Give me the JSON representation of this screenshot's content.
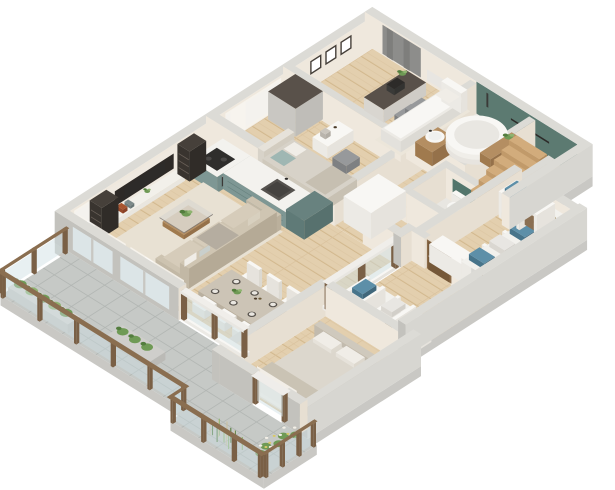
{
  "scene": {
    "description": "3D isometric cutaway floor plan rendering of a furnished apartment with wrap-around terrace",
    "width_px": 615,
    "height_px": 490,
    "background": "#ffffff"
  },
  "palette": {
    "wallTop": "#dcdbd6",
    "wallInner": "#efe8dd",
    "wallInnerDark": "#e7dfd2",
    "wallOuterSW": "#c3c2bd",
    "wallOuterSE": "#d7d6d1",
    "slab": "#c9c8c4",
    "woodFloor": "#e3cfae",
    "woodFloorLine": "#d2b88e",
    "woodFloorLine2": "#d9c19c",
    "terraceTile": "#c6c9c6",
    "terraceTileLine": "#b2b6b3",
    "bathFloor": "#eae8e3",
    "wcFloor": "#e8e6e1",
    "greenWall": "#5c7a71",
    "greenPanel": "#52756b",
    "kitchenTeal": "#7e9794",
    "kitchenTealFront": "#738c89",
    "kitchenTealDark": "#68827f",
    "counter": "#f3f2ee",
    "white": "#f8f7f4",
    "white2": "#eceae5",
    "white3": "#e6e3dd",
    "beige": "#cdc3b0",
    "beigeDark": "#b9ae9a",
    "rug": "#e8e1d3",
    "rug2": "#ece6da",
    "darkWood": "#46403a",
    "darkWood2": "#59514a",
    "gray": "#97999b",
    "grayDark": "#7e8082",
    "glass": "rgba(205,222,226,0.45)",
    "windowGlass": "#dde7e9",
    "railWood": "#8a6e50",
    "railWoodDark": "#7a6046",
    "plant": "#6f9a55",
    "plantDark": "#537d3e",
    "plantLight": "#8fb470",
    "grassTan": "#cbbf9b",
    "sheer": "rgba(247,244,238,0.88)",
    "curtainGray": "#8d8d8b",
    "curtainGrayDark": "#7e7e7c",
    "black": "#2d2b29",
    "blueBox": "#5d8fa8",
    "blueBoxDark": "#47748a",
    "bedding": "#d7d2c8",
    "beddingDark": "#c6bfb1",
    "pillow": "#f0ede7",
    "tealPillow": "#9fb7b3",
    "doorWood": "#8a6a48",
    "doorWoodDark": "#755838",
    "stepWood": "#d2ac7c",
    "stepWoodSide": "#b08a5c",
    "vanityWood": "#b48e62",
    "vanityWoodDark": "#95714a",
    "clothA": "#d9d8d4",
    "clothB": "#c4cdd2",
    "clothC": "#8a6f52",
    "clothD": "#e3e0da"
  },
  "rooms": [
    {
      "name": "living-room",
      "furniture": [
        "tv-wall-unit",
        "tv-screen",
        "bookshelf-tower-left",
        "bookshelf-tower-right",
        "media-shelf",
        "area-rug",
        "sofa",
        "sofa-pillows",
        "coffee-table",
        "coffee-table-plant",
        "dining-table",
        "dining-chairs",
        "place-settings",
        "centerpiece-plant",
        "sheer-curtains"
      ]
    },
    {
      "name": "kitchen",
      "furniture": [
        "counter-run-hob",
        "cooktop",
        "oven",
        "counter-run-sink",
        "sink",
        "tall-end-cabinet"
      ]
    },
    {
      "name": "bedroom-2",
      "furniture": [
        "double-bed-teal-pillows",
        "headboard",
        "vanity-desk",
        "bench-stool",
        "wardrobe",
        "window-sheer-curtain"
      ]
    },
    {
      "name": "home-office",
      "furniture": [
        "desk",
        "laptop",
        "desk-plant",
        "office-chair",
        "daybed",
        "picture-frames",
        "gray-curtain",
        "radiator"
      ]
    },
    {
      "name": "bathroom",
      "furniture": [
        "green-feature-wall",
        "towel-rail",
        "shower-fixture",
        "freestanding-bathtub",
        "wood-vanity",
        "round-basin",
        "wood-bench",
        "bathroom-plant"
      ]
    },
    {
      "name": "wc",
      "furniture": [
        "green-panel",
        "toilet"
      ]
    },
    {
      "name": "hallway",
      "furniture": [
        "white-sideboard",
        "staircase"
      ]
    },
    {
      "name": "entry",
      "furniture": [
        "wood-entry-door",
        "open-wardrobe-south",
        "open-wardrobe-east",
        "hanging-clothes",
        "storage-boxes",
        "white-cabinet"
      ]
    },
    {
      "name": "bedroom-1",
      "furniture": [
        "double-bed",
        "headboard",
        "bed-pillows",
        "blanket",
        "area-rug",
        "open-closet",
        "glass-door",
        "sheer-curtain"
      ]
    },
    {
      "name": "terrace",
      "furniture": [
        "stone-tile-floor",
        "glass-railing",
        "wood-posts",
        "handrail",
        "planter-box-1",
        "planter-box-2",
        "shrubs",
        "ornamental-grasses",
        "flower-bed"
      ]
    }
  ]
}
